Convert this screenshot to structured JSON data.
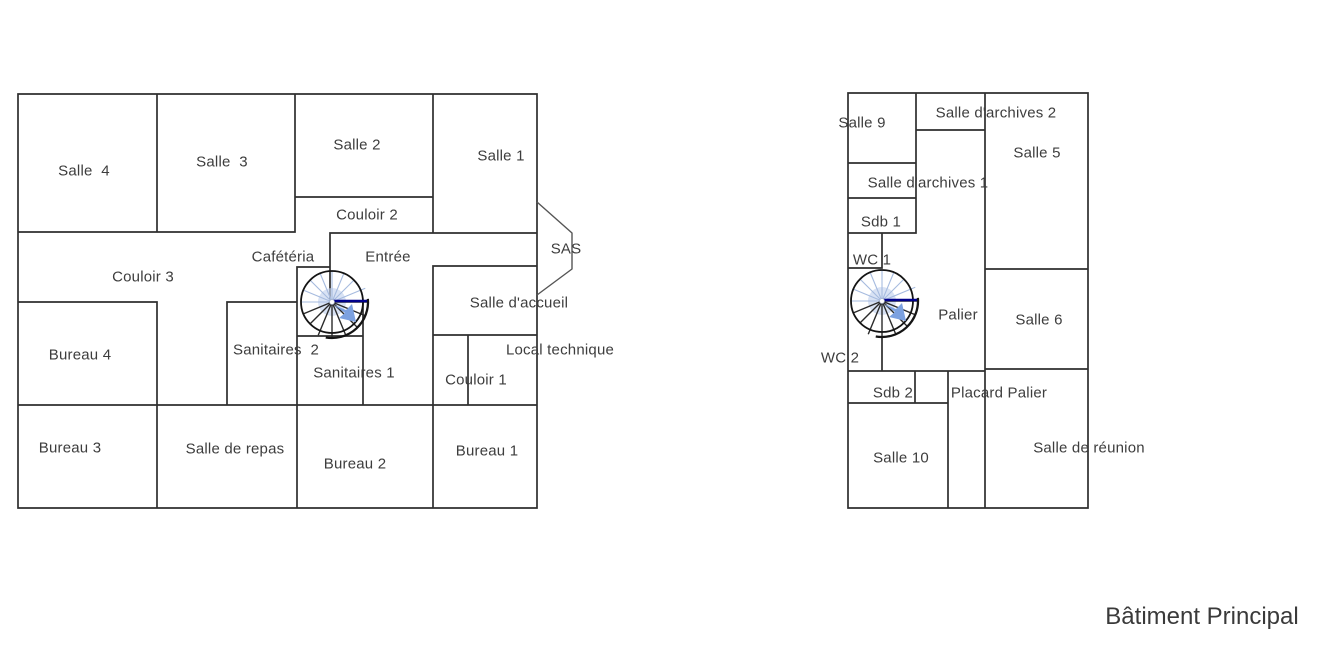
{
  "title": {
    "text": "Bâtiment Principal"
  },
  "colors": {
    "wall": "#2e2e2e",
    "label_text": "#3d3d3d",
    "stair_outline": "#141414",
    "stair_navy": "#00008b",
    "stair_blue_arrow": "#7ca1e0",
    "stair_light_blue": "#c3d3ee",
    "stair_spoke_light": "#a6bbdf",
    "stair_spoke_dark": "#2a2a2a"
  },
  "plans": {
    "ground_floor": {
      "rooms": [
        {
          "id": "salle-4",
          "label": "Salle  4"
        },
        {
          "id": "salle-3",
          "label": "Salle  3"
        },
        {
          "id": "salle-2",
          "label": "Salle 2"
        },
        {
          "id": "salle-1",
          "label": "Salle 1"
        },
        {
          "id": "couloir-2",
          "label": "Couloir 2"
        },
        {
          "id": "couloir-3",
          "label": "Couloir 3"
        },
        {
          "id": "cafeteria",
          "label": "Cafétéria"
        },
        {
          "id": "entree",
          "label": "Entrée"
        },
        {
          "id": "sas",
          "label": "SAS"
        },
        {
          "id": "salle-daccueil",
          "label": "Salle d'accueil"
        },
        {
          "id": "sanitaires-2",
          "label": "Sanitaires  2"
        },
        {
          "id": "sanitaires-1",
          "label": "Sanitaires 1"
        },
        {
          "id": "local-technique",
          "label": "Local technique"
        },
        {
          "id": "couloir-1",
          "label": "Couloir 1"
        },
        {
          "id": "bureau-4",
          "label": "Bureau 4"
        },
        {
          "id": "bureau-3",
          "label": "Bureau 3"
        },
        {
          "id": "salle-de-repas",
          "label": "Salle de repas"
        },
        {
          "id": "bureau-2",
          "label": "Bureau 2"
        },
        {
          "id": "bureau-1",
          "label": "Bureau 1"
        }
      ]
    },
    "upper_floor": {
      "rooms": [
        {
          "id": "salle-9",
          "label": "Salle 9"
        },
        {
          "id": "salle-darchives-2",
          "label": "Salle d'archives 2"
        },
        {
          "id": "salle-5",
          "label": "Salle 5"
        },
        {
          "id": "salle-darchives-1",
          "label": "Salle d'archives 1"
        },
        {
          "id": "sdb-1",
          "label": "Sdb 1"
        },
        {
          "id": "wc-1",
          "label": "WC 1"
        },
        {
          "id": "palier",
          "label": "Palier"
        },
        {
          "id": "salle-6",
          "label": "Salle 6"
        },
        {
          "id": "wc-2",
          "label": "WC 2"
        },
        {
          "id": "sdb-2",
          "label": "Sdb 2"
        },
        {
          "id": "placard-palier",
          "label": "Placard Palier"
        },
        {
          "id": "salle-10",
          "label": "Salle 10"
        },
        {
          "id": "salle-de-reunion",
          "label": "Salle de réunion"
        }
      ]
    }
  }
}
